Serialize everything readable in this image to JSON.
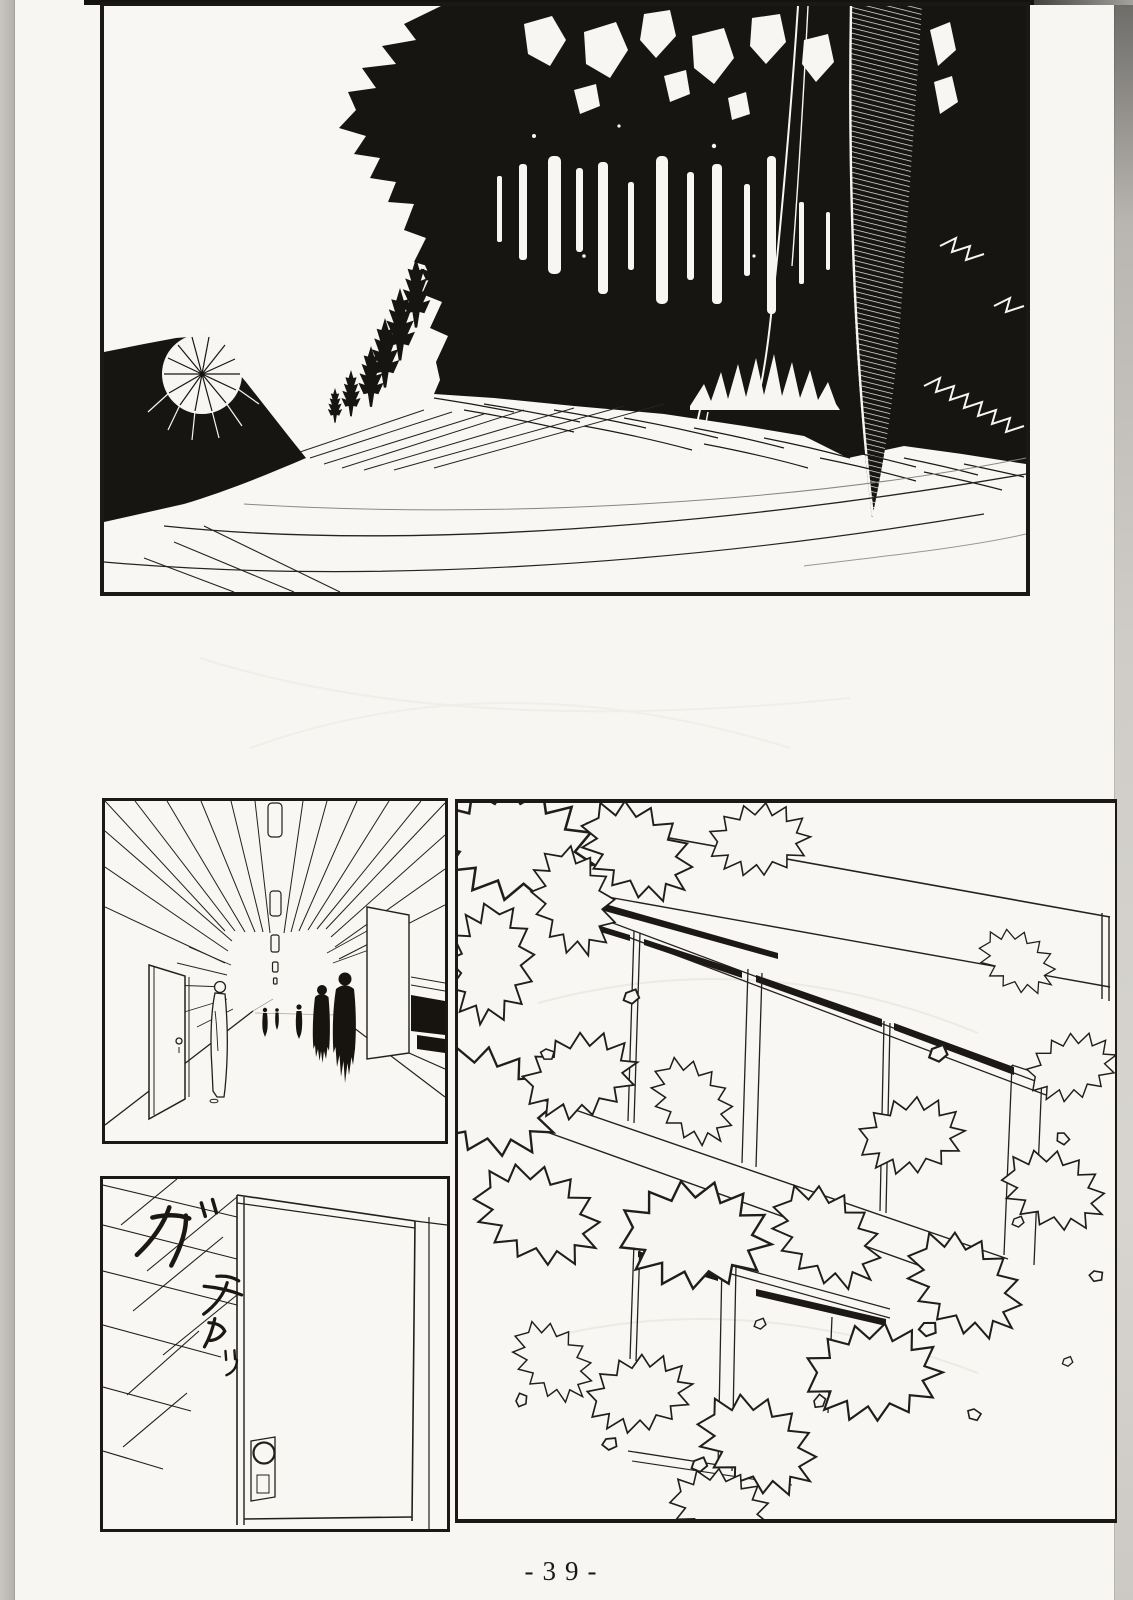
{
  "page": {
    "kind": "scanned manga page",
    "page_number": "-39-",
    "colors": {
      "paper": "#f8f6f2",
      "ink": "#1b1815",
      "edge_shadow_left": "#bfbcb8",
      "edge_shadow_right": "#8a8784"
    }
  },
  "panels": {
    "forest": {
      "alt": "dark forest silhouette above a grassy hillside"
    },
    "corridor": {
      "alt": "bright corridor with silhouetted figures walking away"
    },
    "door": {
      "alt": "closed door with round knob, ceiling grid above",
      "sfx": [
        "ガ",
        "チャッ"
      ]
    },
    "building": {
      "alt": "building facade with window bands behind leafy foliage"
    }
  }
}
